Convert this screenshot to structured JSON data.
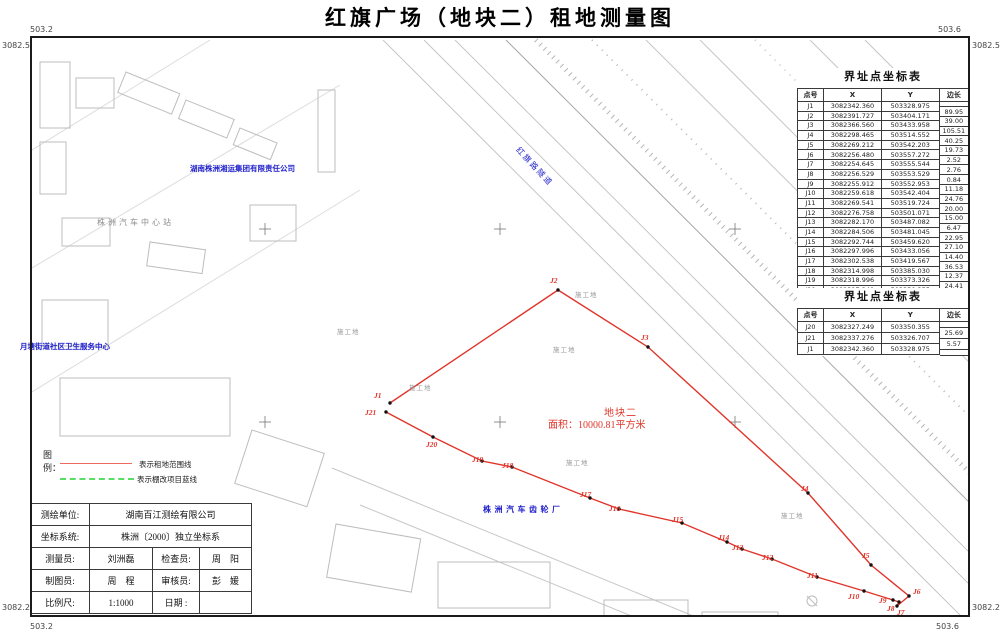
{
  "title": "红旗广场（地块二）租地测量图",
  "corner_labels": {
    "top_left_e": "503.2",
    "top_left_n": "3082.5",
    "top_right_e": "503.6",
    "top_right_n": "3082.5",
    "bottom_left_n": "3082.2",
    "bottom_left_e": "503.2",
    "bottom_right_n": "3082.2",
    "bottom_right_e": "503.6"
  },
  "coordinate_tables": [
    {
      "title": "界址点坐标表",
      "headers": {
        "point": "点号",
        "x": "X",
        "y": "Y",
        "edge": "边长"
      },
      "rows": [
        [
          "J1",
          "3082342.360",
          "503328.975"
        ],
        [
          "J2",
          "3082391.727",
          "503404.171"
        ],
        [
          "J3",
          "3082366.560",
          "503433.958"
        ],
        [
          "J4",
          "3082298.465",
          "503514.552"
        ],
        [
          "J5",
          "3082269.212",
          "503542.203"
        ],
        [
          "J6",
          "3082256.480",
          "503557.272"
        ],
        [
          "J7",
          "3082254.645",
          "503555.544"
        ],
        [
          "J8",
          "3082256.529",
          "503553.529"
        ],
        [
          "J9",
          "3082255.912",
          "503552.953"
        ],
        [
          "J10",
          "3082259.618",
          "503542.404"
        ],
        [
          "J11",
          "3082269.541",
          "503519.724"
        ],
        [
          "J12",
          "3082276.758",
          "503501.071"
        ],
        [
          "J13",
          "3082282.170",
          "503487.082"
        ],
        [
          "J14",
          "3082284.506",
          "503481.045"
        ],
        [
          "J15",
          "3082292.744",
          "503459.620"
        ],
        [
          "J16",
          "3082297.996",
          "503433.056"
        ],
        [
          "J17",
          "3082302.538",
          "503419.567"
        ],
        [
          "J18",
          "3082314.998",
          "503385.030"
        ],
        [
          "J19",
          "3082318.996",
          "503373.326"
        ],
        [
          "J20",
          "3082327.249",
          "503350.355"
        ]
      ],
      "edge_lengths": [
        "89.95",
        "39.00",
        "105.51",
        "40.25",
        "19.73",
        "2.52",
        "2.76",
        "0.84",
        "11.18",
        "24.76",
        "20.00",
        "15.00",
        "6.47",
        "22.95",
        "27.10",
        "14.40",
        "36.53",
        "12.37",
        "24.41"
      ]
    },
    {
      "title": "界址点坐标表",
      "headers": {
        "point": "点号",
        "x": "X",
        "y": "Y",
        "edge": "边长"
      },
      "rows": [
        [
          "J20",
          "3082327.249",
          "503350.355"
        ],
        [
          "J21",
          "3082337.276",
          "503326.707"
        ],
        [
          "J1",
          "3082342.360",
          "503328.975"
        ]
      ],
      "edge_lengths": [
        "25.69",
        "5.57"
      ]
    }
  ],
  "parcel": {
    "name": "地块二",
    "area": "面积：10000.81平方米"
  },
  "legend": {
    "title": "图例：",
    "items": [
      {
        "label": "表示租地范围线",
        "style": "solid-red"
      },
      {
        "label": "表示棚改项目蓝线",
        "style": "dashed-green"
      }
    ]
  },
  "info_table": {
    "rows": [
      {
        "cells": [
          {
            "t": "测绘单位:"
          },
          {
            "t": "湖南百江测绘有限公司",
            "span": 3
          }
        ]
      },
      {
        "cells": [
          {
            "t": "坐标系统:"
          },
          {
            "t": "株洲〔2000〕独立坐标系",
            "span": 3
          }
        ]
      },
      {
        "cells": [
          {
            "t": "测量员:"
          },
          {
            "t": "刘洲磊"
          },
          {
            "t": "检查员:"
          },
          {
            "t": "周　阳"
          }
        ]
      },
      {
        "cells": [
          {
            "t": "制图员:"
          },
          {
            "t": "周　程"
          },
          {
            "t": "审核员:"
          },
          {
            "t": "彭　媛"
          }
        ]
      },
      {
        "cells": [
          {
            "t": "比例尺:"
          },
          {
            "t": "1:1000"
          },
          {
            "t": "日期 :"
          },
          {
            "t": ""
          }
        ]
      }
    ]
  },
  "map_labels": [
    {
      "name": "company-label",
      "text": "湖南株洲湘运集团有限责任公司",
      "style": "blue",
      "x": 190,
      "y": 165
    },
    {
      "name": "bus-station-label",
      "text": "株洲汽车中心站",
      "style": "gray-spaced",
      "x": 97,
      "y": 219
    },
    {
      "name": "health-center-label",
      "text": "月塘街道社区卫生服务中心",
      "style": "blue",
      "x": 20,
      "y": 343
    },
    {
      "name": "gear-factory-label",
      "text": "株洲汽车齿轮厂",
      "style": "blue-spaced",
      "x": 483,
      "y": 506
    },
    {
      "name": "tunnel-label",
      "text": "红旗路隧道",
      "style": "blue-rotated",
      "x": 520,
      "y": 146
    },
    {
      "name": "construction-label-1",
      "text": "施工地",
      "style": "gray-small",
      "x": 337,
      "y": 329
    },
    {
      "name": "construction-label-2",
      "text": "施工地",
      "style": "gray-small",
      "x": 409,
      "y": 385
    },
    {
      "name": "construction-label-3",
      "text": "施工地",
      "style": "gray-small",
      "x": 553,
      "y": 347
    },
    {
      "name": "construction-label-4",
      "text": "施工地",
      "style": "gray-small",
      "x": 566,
      "y": 460
    },
    {
      "name": "construction-label-5",
      "text": "施工地",
      "style": "gray-small",
      "x": 781,
      "y": 513
    },
    {
      "name": "construction-label-6",
      "text": "施工地",
      "style": "gray-small",
      "x": 575,
      "y": 292
    }
  ],
  "boundary": {
    "points": [
      {
        "id": "J1",
        "vx": 390,
        "vy": 403,
        "lx": 374,
        "ly": 391
      },
      {
        "id": "J2",
        "vx": 558,
        "vy": 290,
        "lx": 550,
        "ly": 276
      },
      {
        "id": "J3",
        "vx": 648,
        "vy": 347,
        "lx": 641,
        "ly": 333
      },
      {
        "id": "J4",
        "vx": 808,
        "vy": 493,
        "lx": 801,
        "ly": 484
      },
      {
        "id": "J5",
        "vx": 871,
        "vy": 565,
        "lx": 862,
        "ly": 551
      },
      {
        "id": "J6",
        "vx": 909,
        "vy": 596,
        "lx": 913,
        "ly": 587
      },
      {
        "id": "J7",
        "vx": 897,
        "vy": 606,
        "lx": 897,
        "ly": 608
      },
      {
        "id": "J8",
        "vx": 899,
        "vy": 602,
        "lx": 887,
        "ly": 604
      },
      {
        "id": "J9",
        "vx": 893,
        "vy": 600,
        "lx": 879,
        "ly": 596
      },
      {
        "id": "J10",
        "vx": 864,
        "vy": 591,
        "lx": 848,
        "ly": 592
      },
      {
        "id": "J11",
        "vx": 817,
        "vy": 577,
        "lx": 807,
        "ly": 571
      },
      {
        "id": "J12",
        "vx": 772,
        "vy": 559,
        "lx": 762,
        "ly": 553
      },
      {
        "id": "J13",
        "vx": 742,
        "vy": 549,
        "lx": 732,
        "ly": 543
      },
      {
        "id": "J14",
        "vx": 727,
        "vy": 542,
        "lx": 718,
        "ly": 533
      },
      {
        "id": "J15",
        "vx": 682,
        "vy": 523,
        "lx": 672,
        "ly": 515
      },
      {
        "id": "J16",
        "vx": 619,
        "vy": 509,
        "lx": 609,
        "ly": 504
      },
      {
        "id": "J17",
        "vx": 590,
        "vy": 498,
        "lx": 580,
        "ly": 490
      },
      {
        "id": "J18",
        "vx": 512,
        "vy": 467,
        "lx": 502,
        "ly": 461
      },
      {
        "id": "J19",
        "vx": 482,
        "vy": 461,
        "lx": 472,
        "ly": 455
      },
      {
        "id": "J20",
        "vx": 433,
        "vy": 437,
        "lx": 426,
        "ly": 440
      },
      {
        "id": "J21",
        "vx": 386,
        "vy": 412,
        "lx": 365,
        "ly": 408
      }
    ]
  },
  "colors": {
    "boundary_red": "#e0352b",
    "legend_red": "#ee6a5e",
    "legend_green": "#58de66",
    "label_blue": "#2121cc",
    "base_gray": "#c6c6c6"
  }
}
